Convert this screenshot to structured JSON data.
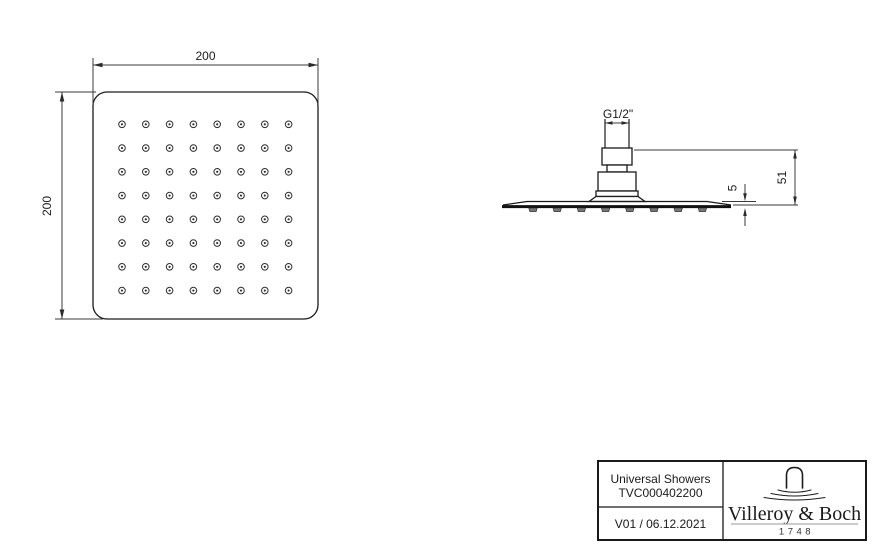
{
  "drawing": {
    "top_view": {
      "width_label": "200",
      "height_label": "200",
      "nozzle_rows": 8,
      "nozzle_cols": 8
    },
    "side_view": {
      "thread_label": "G1/2\"",
      "overall_height_label": "51",
      "plate_thickness_label": "5",
      "bump_count": 8
    }
  },
  "title_block": {
    "product_line": "Universal Showers",
    "article_number": "TVC000402200",
    "version_date": "V01 / 06.12.2021",
    "brand": {
      "name": "Villeroy & Boch",
      "year": "1748"
    }
  }
}
